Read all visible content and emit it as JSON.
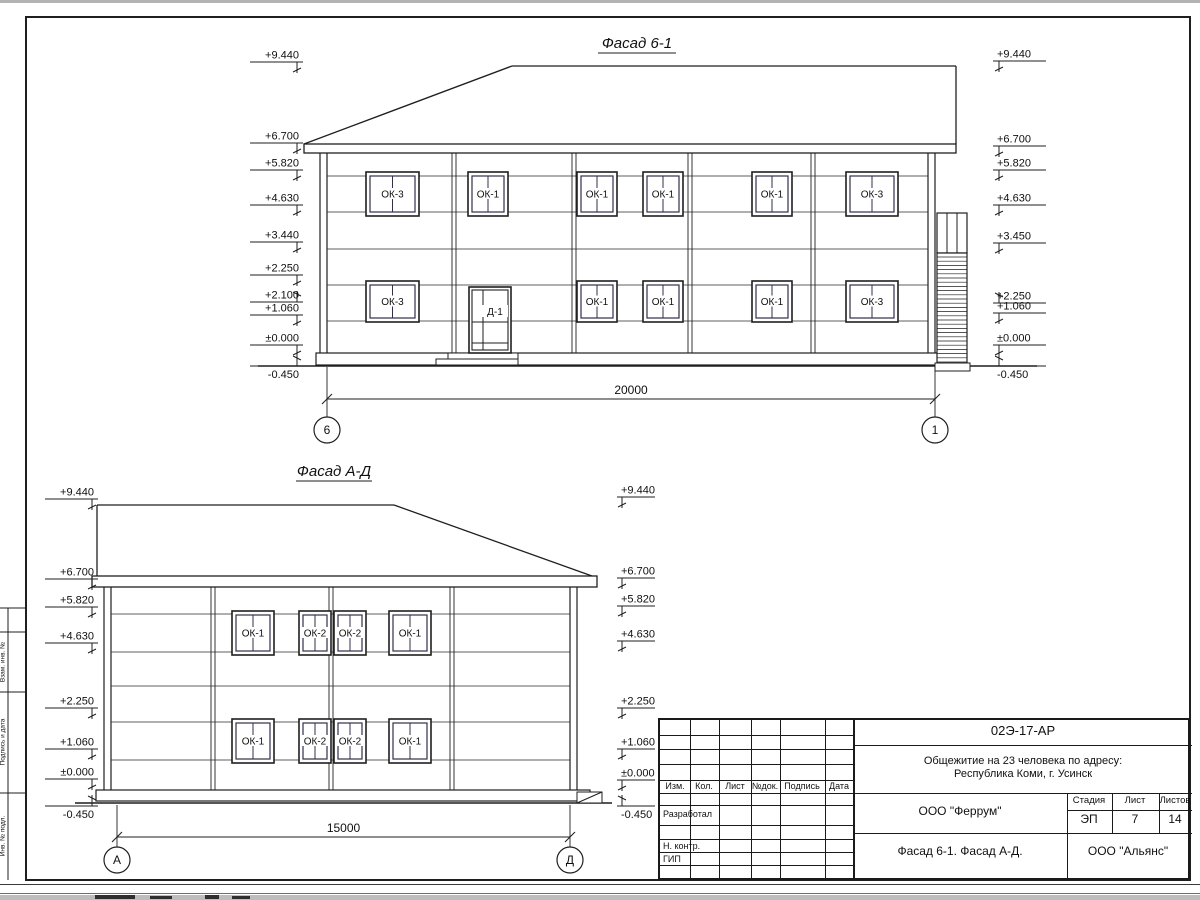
{
  "sheet_edge": {
    "top_color": "#b3b3b3",
    "band_color": "#bdbdbd"
  },
  "line_color": "#1f1f1f",
  "facades": [
    {
      "title": "Фасад 6-1",
      "dimension_label": "20000",
      "axis_left": "6",
      "axis_right": "1",
      "door_label": "Д-1",
      "marks_left": [
        {
          "label": "+9.440",
          "y": 62,
          "dir": "down"
        },
        {
          "label": "+6.700",
          "y": 143,
          "dir": "down"
        },
        {
          "label": "+5.820",
          "y": 170,
          "dir": "down"
        },
        {
          "label": "+4.630",
          "y": 205,
          "dir": "down"
        },
        {
          "label": "+3.440",
          "y": 242,
          "dir": "down"
        },
        {
          "label": "+2.250",
          "y": 275,
          "dir": "down"
        },
        {
          "label": "+2.100",
          "y": 302,
          "dir": "up"
        },
        {
          "label": "+1.060",
          "y": 315,
          "dir": "down"
        },
        {
          "label": "±0.000",
          "y": 345,
          "dir": "down"
        },
        {
          "label": "-0.450",
          "y": 366,
          "dir": "up-below"
        }
      ],
      "marks_right": [
        {
          "label": "+9.440",
          "y": 61,
          "dir": "down"
        },
        {
          "label": "+6.700",
          "y": 146,
          "dir": "down"
        },
        {
          "label": "+5.820",
          "y": 170,
          "dir": "down"
        },
        {
          "label": "+4.630",
          "y": 205,
          "dir": "down"
        },
        {
          "label": "+3.450",
          "y": 243,
          "dir": "down"
        },
        {
          "label": "+2.250",
          "y": 303,
          "dir": "up"
        },
        {
          "label": "+1.060",
          "y": 313,
          "dir": "down"
        },
        {
          "label": "±0.000",
          "y": 345,
          "dir": "down"
        },
        {
          "label": "-0.450",
          "y": 366,
          "dir": "up-below"
        }
      ],
      "windows_upper": [
        {
          "label": "ОК-3",
          "x": 366,
          "w": 53
        },
        {
          "label": "ОК-1",
          "x": 468,
          "w": 40
        },
        {
          "label": "ОК-1",
          "x": 577,
          "w": 40
        },
        {
          "label": "ОК-1",
          "x": 643,
          "w": 40
        },
        {
          "label": "ОК-1",
          "x": 752,
          "w": 40
        },
        {
          "label": "ОК-3",
          "x": 846,
          "w": 52
        }
      ],
      "windows_lower": [
        {
          "label": "ОК-3",
          "x": 366,
          "w": 53
        },
        {
          "label": "ОК-1",
          "x": 577,
          "w": 40
        },
        {
          "label": "ОК-1",
          "x": 643,
          "w": 40
        },
        {
          "label": "ОК-1",
          "x": 752,
          "w": 40
        },
        {
          "label": "ОК-3",
          "x": 846,
          "w": 52
        }
      ]
    },
    {
      "title": "Фасад А-Д",
      "dimension_label": "15000",
      "axis_left": "А",
      "axis_right": "Д",
      "marks_left": [
        {
          "label": "+9.440",
          "y": 499,
          "dir": "down"
        },
        {
          "label": "+6.700",
          "y": 579,
          "dir": "down"
        },
        {
          "label": "+5.820",
          "y": 607,
          "dir": "down"
        },
        {
          "label": "+4.630",
          "y": 643,
          "dir": "down"
        },
        {
          "label": "+2.250",
          "y": 708,
          "dir": "down"
        },
        {
          "label": "+1.060",
          "y": 749,
          "dir": "down"
        },
        {
          "label": "±0.000",
          "y": 779,
          "dir": "down"
        },
        {
          "label": "-0.450",
          "y": 806,
          "dir": "up-below"
        }
      ],
      "marks_right": [
        {
          "label": "+9.440",
          "y": 497,
          "dir": "down"
        },
        {
          "label": "+6.700",
          "y": 578,
          "dir": "down"
        },
        {
          "label": "+5.820",
          "y": 606,
          "dir": "down"
        },
        {
          "label": "+4.630",
          "y": 641,
          "dir": "down"
        },
        {
          "label": "+2.250",
          "y": 708,
          "dir": "down"
        },
        {
          "label": "+1.060",
          "y": 749,
          "dir": "down"
        },
        {
          "label": "±0.000",
          "y": 780,
          "dir": "down"
        },
        {
          "label": "-0.450",
          "y": 806,
          "dir": "up-below"
        }
      ],
      "windows_upper": [
        {
          "label": "ОК-1",
          "x": 232,
          "w": 42
        },
        {
          "label": "ОК-2",
          "x": 299,
          "w": 32
        },
        {
          "label": "ОК-2",
          "x": 334,
          "w": 32
        },
        {
          "label": "ОК-1",
          "x": 389,
          "w": 42
        }
      ],
      "windows_lower": [
        {
          "label": "ОК-1",
          "x": 232,
          "w": 42
        },
        {
          "label": "ОК-2",
          "x": 299,
          "w": 32
        },
        {
          "label": "ОК-2",
          "x": 334,
          "w": 32
        },
        {
          "label": "ОК-1",
          "x": 389,
          "w": 42
        }
      ]
    }
  ],
  "title_block": {
    "doc_number": "02Э-17-АР",
    "project_name_1": "Общежитие на 23 человека по адресу:",
    "project_name_2": "Республика Коми, г. Усинск",
    "designer": "ООО \"Феррум\"",
    "publisher": "ООО \"Альянс\"",
    "sheet_title": "Фасад 6-1. Фасад  А-Д.",
    "stage_label": "Стадия",
    "stage_value": "ЭП",
    "sheet_label": "Лист",
    "sheet_value": "7",
    "sheets_label": "Листов",
    "sheets_value": "14",
    "columns": [
      "Изм.",
      "Кол.",
      "Лист",
      "№док.",
      "Подпись",
      "Дата"
    ],
    "roles": [
      "Разработал",
      "Н. контр.",
      "ГИП"
    ]
  },
  "side_stamp": [
    "Взам. инв. №",
    "Подпись и дата",
    "Инв. № подл."
  ]
}
